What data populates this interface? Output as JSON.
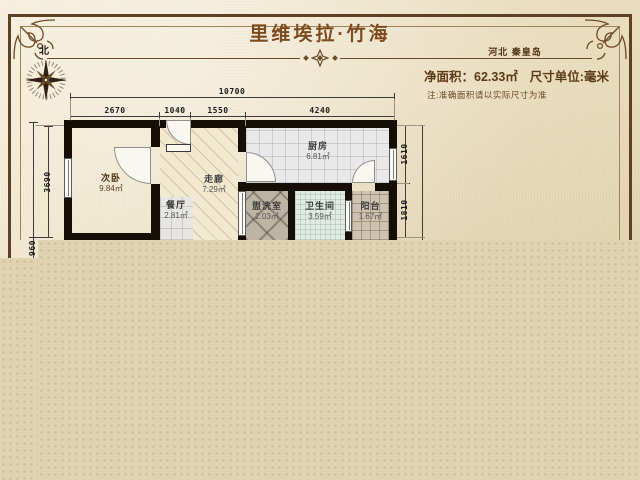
{
  "header": {
    "title": "里维埃拉·竹海",
    "location": "河北 秦皇岛",
    "area_label": "净面积：62.33㎡",
    "unit_label": "尺寸单位:毫米",
    "note": "注:准确面积请以实际尺寸为准",
    "compass_label": "北"
  },
  "floorplan": {
    "rooms": [
      {
        "name": "次卧",
        "area": "9.84㎡"
      },
      {
        "name": "餐厅",
        "area": "2.81㎡"
      },
      {
        "name": "走廊",
        "area": "7.29㎡"
      },
      {
        "name": "厨房",
        "area": "6.81㎡"
      },
      {
        "name": "盥洗室",
        "area": "2.03㎡"
      },
      {
        "name": "卫生间",
        "area": "3.59㎡"
      },
      {
        "name": "阳台",
        "area": "1.67㎡"
      }
    ],
    "dimensions": {
      "top_total": "10700",
      "top_segments": [
        "2670",
        "1040",
        "1550",
        "4240"
      ],
      "left": [
        "3690",
        "960"
      ],
      "right": [
        "1610",
        "1810"
      ]
    }
  },
  "colors": {
    "title_brown": "#7c4a1c",
    "frame_brown": "#5e4124",
    "wall_black": "#150f08",
    "bedroom_floor": "#d07c2c",
    "parchment": "#ece0c3",
    "blank_tan": "#e1d3b1"
  }
}
